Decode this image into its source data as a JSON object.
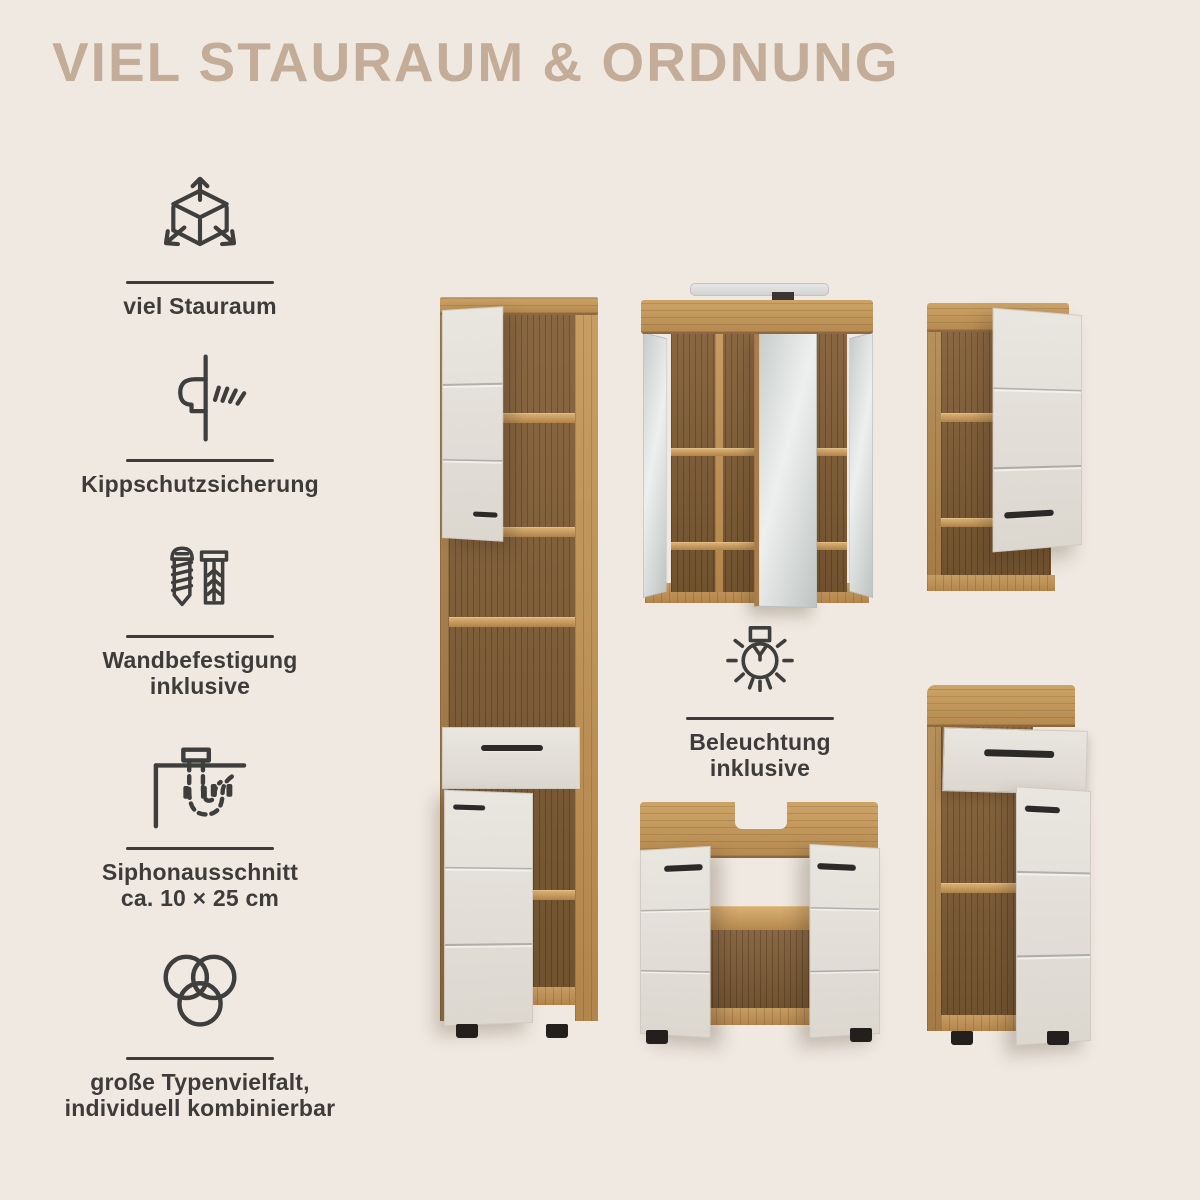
{
  "title": "VIEL STAURAUM & ORDNUNG",
  "colors": {
    "background": "#f0e9e1",
    "title": "#c3ac98",
    "text": "#3d3c3b",
    "wood_light": "#b68a50",
    "wood_dark": "#7d5e3a",
    "door_front": "#e4e1da",
    "handle": "#2c2a28",
    "mirror": "#d9dcdb"
  },
  "features": [
    {
      "icon": "cube-dimensions-icon",
      "line1": "viel Stauraum",
      "line2": ""
    },
    {
      "icon": "anti-tip-anchor-icon",
      "line1": "Kippschutzsicherung",
      "line2": ""
    },
    {
      "icon": "screw-dowel-icon",
      "line1": "Wandbefestigung",
      "line2": "inklusive"
    },
    {
      "icon": "siphon-pipe-icon",
      "line1": "Siphonausschnitt",
      "line2": "ca. 10 × 25 cm"
    },
    {
      "icon": "overlapping-circles-icon",
      "line1": "große Typenvielfalt,",
      "line2": "individuell kombinierbar"
    }
  ],
  "lighting_callout": {
    "icon": "lightbulb-icon",
    "line1": "Beleuchtung",
    "line2": "inklusive"
  }
}
